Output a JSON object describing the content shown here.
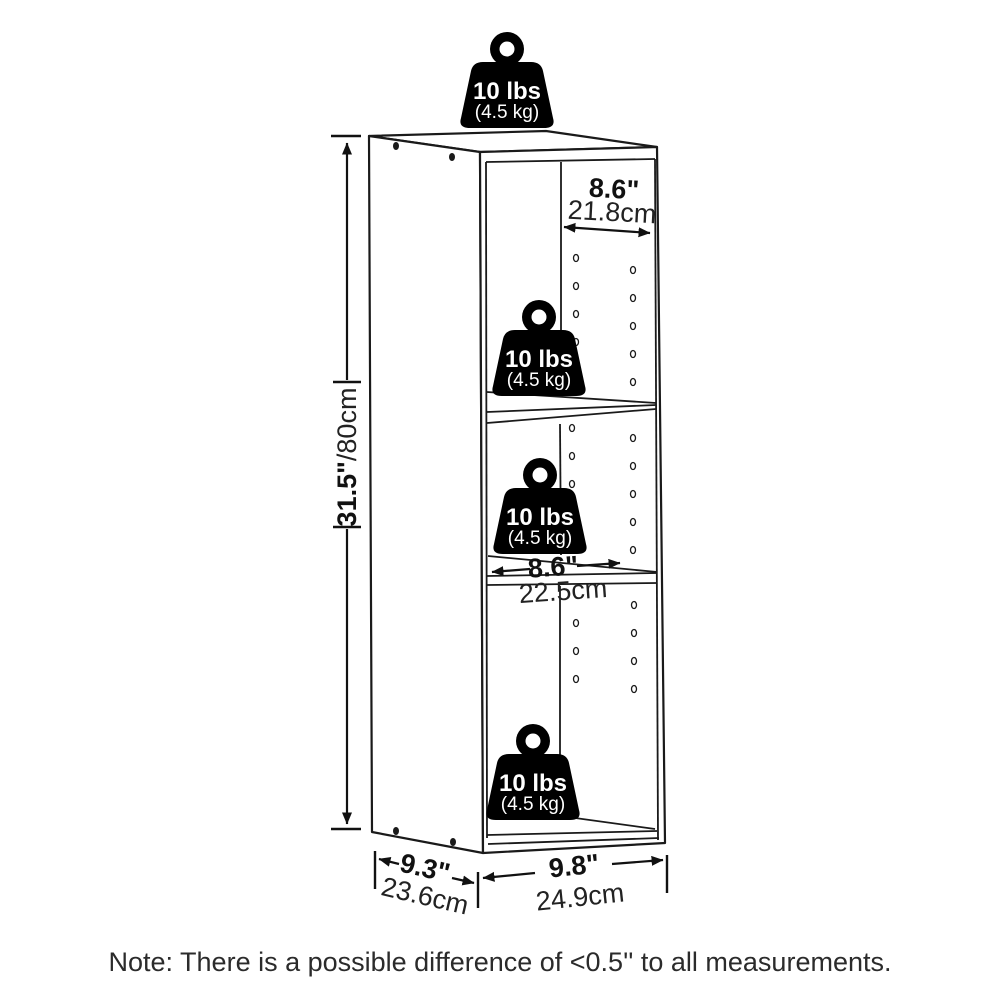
{
  "page": {
    "background": "#ffffff",
    "line_color": "#1a1a1a"
  },
  "weight_badge": {
    "lbs": "10 lbs",
    "kg": "(4.5 kg)",
    "fill_color": "#000000",
    "text_color": "#ffffff",
    "count": 4
  },
  "dimensions": {
    "height_in": "31.5\"",
    "height_cm": "/80cm",
    "top_inner_width_in": "8.6\"",
    "top_inner_width_cm": "21.8cm",
    "middle_inner_width_in": "8.6\"",
    "middle_inner_width_cm": "22.5cm",
    "depth_in": "9.3\"",
    "depth_cm": "23.6cm",
    "bottom_width_in": "9.8\"",
    "bottom_width_cm": "24.9cm"
  },
  "note": "Note: There is a possible difference of <0.5'' to all measurements."
}
